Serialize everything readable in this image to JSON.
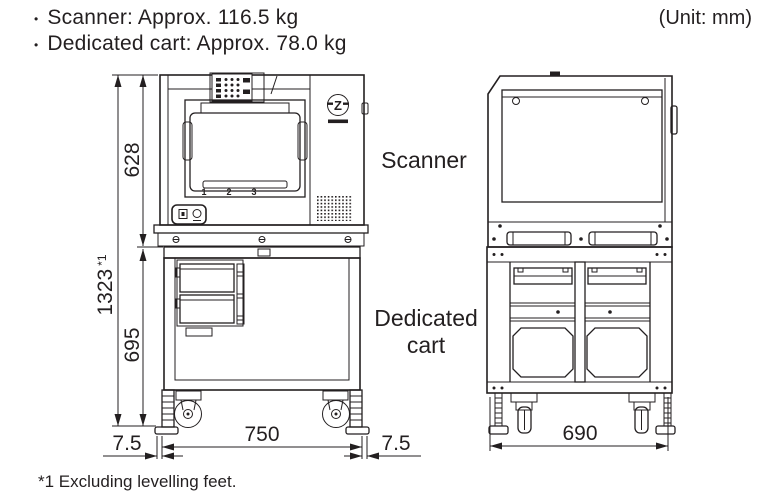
{
  "header": {
    "weights": [
      {
        "bullet": "•",
        "text": "Scanner: Approx. 116.5 kg"
      },
      {
        "bullet": "•",
        "text": "Dedicated cart: Approx. 78.0 kg"
      }
    ],
    "unit_note": "(Unit: mm)"
  },
  "view_labels": {
    "scanner": "Scanner",
    "cart_line1": "Dedicated",
    "cart_line2": "cart"
  },
  "dimensions": {
    "total_height": "1323",
    "total_height_ref": "*1",
    "scanner_height": "628",
    "cart_height": "695",
    "cart_width": "750",
    "overhang_left": "7.5",
    "overhang_right": "7.5",
    "cart_depth": "690"
  },
  "slot_numbers": [
    "1",
    "2",
    "3"
  ],
  "logo_letter": "Z",
  "footnote": "*1 Excluding levelling feet.",
  "colors": {
    "line": "#231f20",
    "background": "#ffffff"
  }
}
